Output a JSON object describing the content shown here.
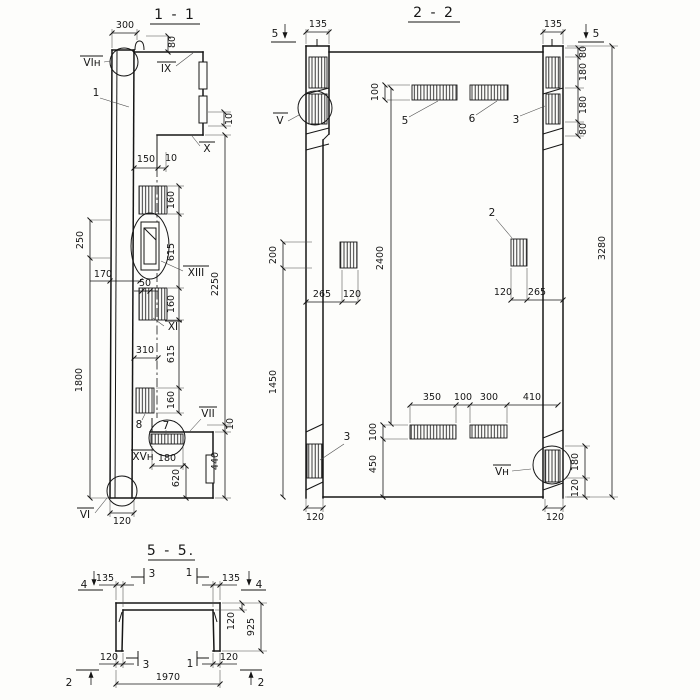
{
  "s11": {
    "title": "1 - 1",
    "labels": {
      "vin": "VIн",
      "part1": "1",
      "ix": "IX",
      "x": "X",
      "xiii": "XIII",
      "xi": "XI",
      "part8": "8",
      "part7": "7",
      "vii": "VII",
      "xvn": "XVн",
      "vi": "VI"
    },
    "dims": {
      "d300": "300",
      "d80": "80",
      "d10top": "10",
      "d150": "150",
      "d10mid": "10",
      "c160a": "160",
      "c615a": "615",
      "c160b": "160",
      "c615b": "615",
      "c160c": "160",
      "d2250": "2250",
      "d10low": "10",
      "d440": "440",
      "d250": "250",
      "d170": "170",
      "d1800": "1800",
      "d310": "310",
      "d50": "50",
      "d180": "180",
      "d620": "620",
      "d120": "120"
    }
  },
  "s22": {
    "title": "2 - 2",
    "markers": {
      "m5l": "5",
      "m5r": "5"
    },
    "labels": {
      "v": "V",
      "b5": "5",
      "b6": "6",
      "n3top": "3",
      "n2": "2",
      "n3bot": "3",
      "vn": "Vн"
    },
    "dims": {
      "d135l": "135",
      "d135r": "135",
      "d100top": "100",
      "c80a": "80",
      "c180a": "180",
      "c180b": "180",
      "c80b": "80",
      "d3280": "3280",
      "d200": "200",
      "d265l": "265",
      "d120l": "120",
      "d2400": "2400",
      "d120m": "120",
      "d265r": "265",
      "d1450": "1450",
      "d350": "350",
      "d100m": "100",
      "d300": "300",
      "d410": "410",
      "d100bot": "100",
      "d450": "450",
      "d180r": "180",
      "d120r": "120",
      "d120cl": "120",
      "d120cr": "120"
    }
  },
  "s55": {
    "title": "5 - 5.",
    "markers": {
      "m4l": "4",
      "m4r": "4",
      "m3t": "3",
      "m1t": "1",
      "m3b": "3",
      "m1b": "1",
      "m2l": "2",
      "m2r": "2"
    },
    "dims": {
      "d135l": "135",
      "d135r": "135",
      "d120t": "120",
      "d925": "925",
      "d120bl": "120",
      "d120br": "120",
      "d1970": "1970"
    }
  }
}
